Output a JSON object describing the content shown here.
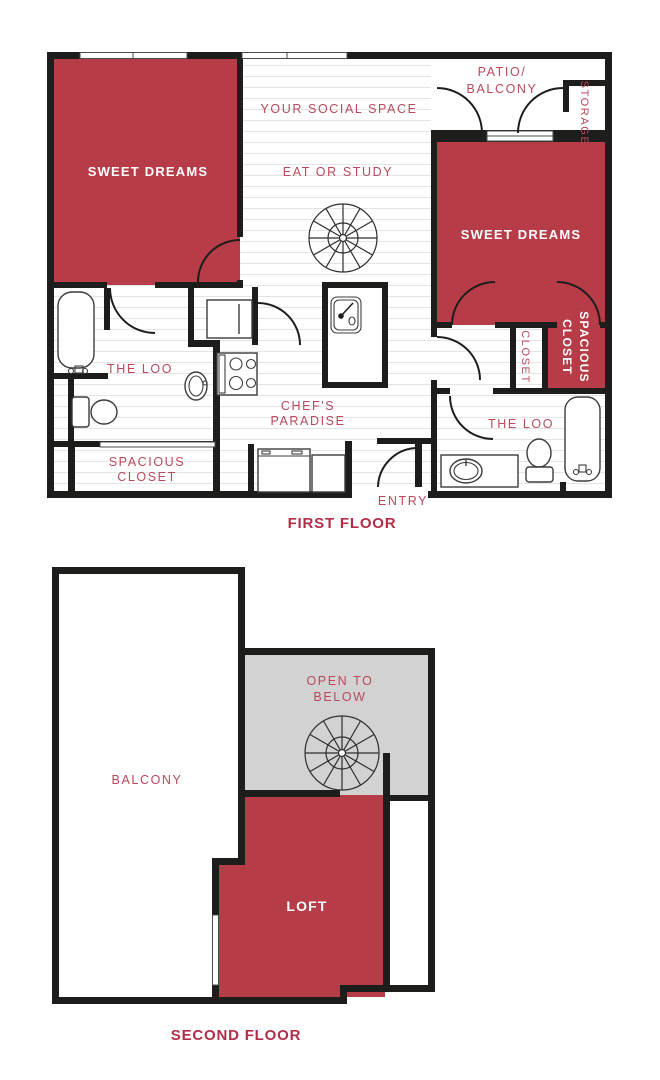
{
  "colors": {
    "wall": "#1d1d1b",
    "room_red": "#b63c48",
    "label_red": "#b9495b",
    "title_red": "#b22e48",
    "white_label": "#ffffff",
    "open_below_gray": "#d2d2d2",
    "floor_line": "#e4e4e4"
  },
  "first_floor": {
    "title": "FIRST FLOOR",
    "labels": {
      "bedroom_left": "SWEET DREAMS",
      "social_space": "YOUR SOCIAL SPACE",
      "eat_or_study": "EAT OR STUDY",
      "patio_l1": "PATIO/",
      "patio_l2": "BALCONY",
      "storage": "STORAGE",
      "bedroom_right": "SWEET DREAMS",
      "loo_left": "THE LOO",
      "loo_right": "THE LOO",
      "spacious_closet_left_l1": "SPACIOUS",
      "spacious_closet_left_l2": "CLOSET",
      "closet": "CLOSET",
      "spacious_closet_right_l1": "SPACIOUS",
      "spacious_closet_right_l2": "CLOSET",
      "kitchen_l1": "CHEF'S",
      "kitchen_l2": "PARADISE",
      "entry": "ENTRY"
    }
  },
  "second_floor": {
    "title": "SECOND FLOOR",
    "labels": {
      "balcony": "BALCONY",
      "open_below_l1": "OPEN TO",
      "open_below_l2": "BELOW",
      "loft": "LOFT"
    }
  }
}
